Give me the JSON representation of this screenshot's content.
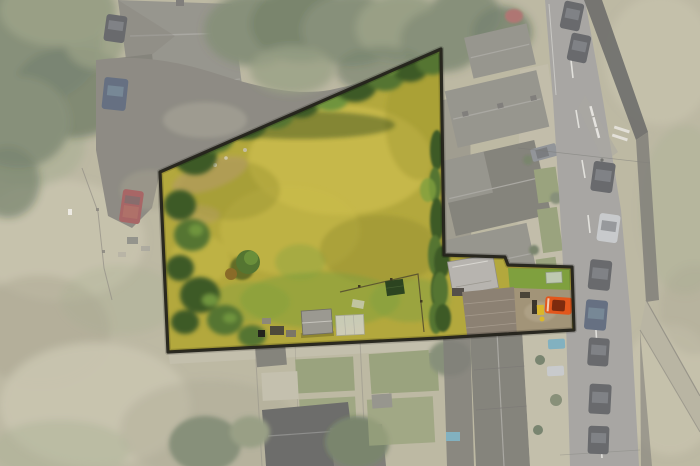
{
  "meta": {
    "alt_text": "Aerial drone photograph of an irregular building plot of rough yellow-green meadow, outlined with a dark boundary line and highlighted in full colour, while the surrounding village scene of stone houses, gardens, a main road with parked cars and grazing fields is shown faded and desaturated."
  },
  "colors": {
    "field_base": "#918a67",
    "field_light": "#a59e7b",
    "field_dark": "#706948",
    "field_green": "#6e7a4a",
    "tree": "#394621",
    "tree_dark": "#213411",
    "tree_light": "#556135",
    "roof": "#535043",
    "roof_dark": "#353225",
    "roof_light": "#716e64",
    "drive": "#433f32",
    "road": "#6e6c66",
    "road_mark": "#dfdcd5",
    "wall_dark": "#14140f",
    "wall_mid": "#2e2b22",
    "wall_light": "#8a8466",
    "lawn": "#576728",
    "path": "#9d9678",
    "car_dark": "#05080d",
    "car_gray": "#4a4f55",
    "car_silver": "#a3a7aa",
    "car_blue": "#001230",
    "car_teal": "#2f7d96",
    "car_red": "#6e0000",
    "dark_roof": "#0c0c09",
    "plot_grass": "#b3a83d",
    "plot_grass_light": "#cabc4c",
    "plot_grass_dark": "#97912f",
    "plot_green": "#7fa03e",
    "plot_tree": "#3c5a27",
    "plot_tree_mid": "#547531",
    "plot_tree_light": "#6f943c",
    "plot_tree_shadow": "#243c16",
    "dirt": "#b49d61",
    "shed_gray": "#9b9991",
    "shed_white": "#d2d2cb",
    "shed_green": "#2c4420",
    "bright_roof": "#b7b4af",
    "bright_roof_brown": "#8c8173",
    "courtyard": "#a29478",
    "orange_car": "#e2571c",
    "orange_car_dark": "#7e2b0e",
    "yellow_bin": "#d9b72b",
    "boundary": "#24231b",
    "fade_white": "#ffffff"
  },
  "scene": {
    "highlighted_plot": {
      "label": "land plot highlighted with dark boundary outline",
      "ground": "overgrown yellow-green meadow grass",
      "features": [
        "tree band along north boundary",
        "tree cluster along west boundary",
        "round shrub with brown shrub beside it",
        "grey shed",
        "white greenhouse",
        "dark green shed",
        "paddock fence line",
        "hedge along east boundary",
        "outbuilding with light grey roof",
        "pitched-roof outbuilding",
        "courtyard with parked orange car",
        "yellow bin"
      ]
    },
    "surroundings": {
      "label": "faded desaturated context",
      "features": [
        "stone house with grey hipped roofs (top left)",
        "gravel driveway with red car, blue car and dark car",
        "rough grazing field with fence line (left)",
        "woodland (top left corner)",
        "overhanging tree canopy along north boundary",
        "terraced houses with grey slate roofs (right)",
        "front gardens with small lawns and shrubs",
        "main road running top to bottom with dashed centre line and bus-stop road markings",
        "dark roadside wall and diagonal stone path (far right)",
        "row of parked cars along the road",
        "rear gardens, sheds and dark-roofed houses (bottom)",
        "long terraced roof running to bottom edge"
      ]
    },
    "counts": {
      "parked_cars_on_road": 9,
      "cars_off_road": 6,
      "sheds_in_plot": 3
    }
  }
}
